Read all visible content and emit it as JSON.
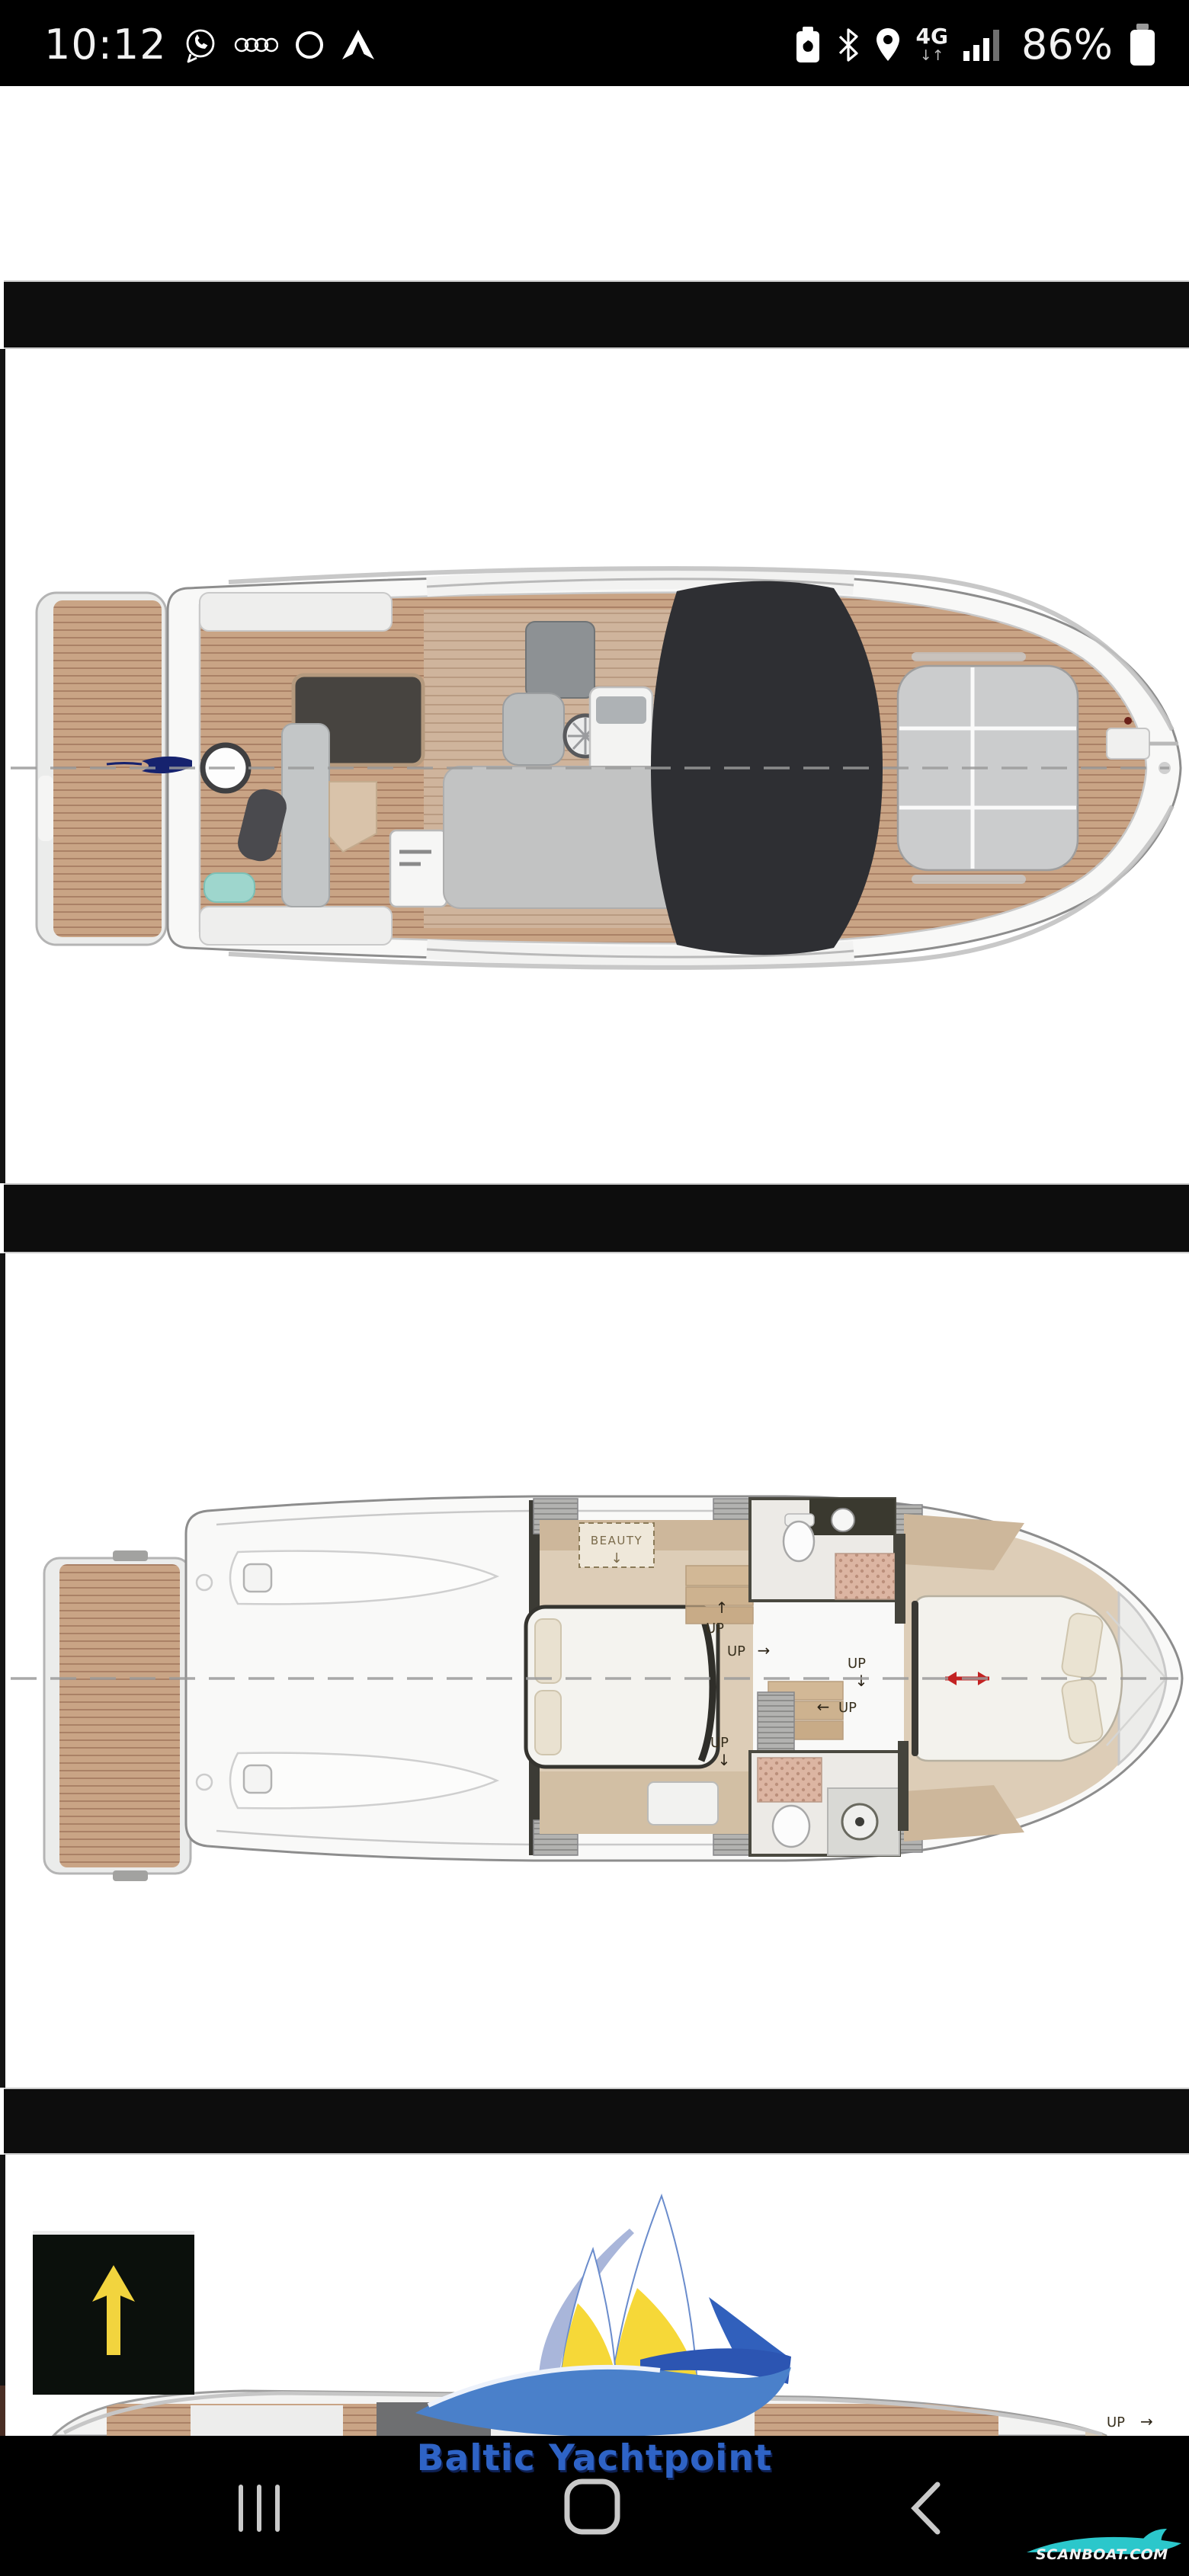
{
  "status_bar": {
    "time": "10:12",
    "network_type": "4G",
    "network_arrows": "↓↑",
    "battery_percent": "86%",
    "left_icons": [
      "whatsapp",
      "audi-rings",
      "circle-notification",
      "android-auto"
    ],
    "right_icons": [
      "battery-saver",
      "bluetooth",
      "location",
      "mobile-data-4g",
      "signal-strength",
      "battery"
    ]
  },
  "gallery": {
    "cabin_plan": {
      "beauty_label": "BEAUTY",
      "beauty_arrow": "↓",
      "up_label_1": "UP",
      "up_arrow_1": "↑",
      "up_label_2": "UP",
      "up_arrow_2": "→",
      "up_label_3": "UP",
      "up_arrow_3": "↓",
      "up_label_4": "UP",
      "up_arrow_4": "←",
      "up_label_5": "UP",
      "up_arrow_5": "↓"
    },
    "flybridge_plan": {
      "up_label": "UP",
      "up_arrow": "→"
    }
  },
  "branding": {
    "watermark": "Baltic Yachtpoint",
    "watermark_color": "#2e63c6",
    "scanboat": "SCANBOAT.COM",
    "scanboat_accent": "#2bc7cb"
  },
  "nav_bar": {
    "icons": [
      "recents",
      "home",
      "back"
    ]
  },
  "palette": {
    "teak": "#c9a485",
    "teak_stripe": "#aa8166",
    "hull_white": "#f8f8f7",
    "dark_glass": "#2e2f33",
    "cabin_floor": "#ddcdb7",
    "dark_wall": "#3c3b35",
    "logo_blue": "#4a80ca",
    "logo_royal": "#2c55b2",
    "logo_yellow": "#f6d838",
    "red_arrow": "#c32222",
    "scroll_arrow_yellow": "#f2d43e"
  }
}
